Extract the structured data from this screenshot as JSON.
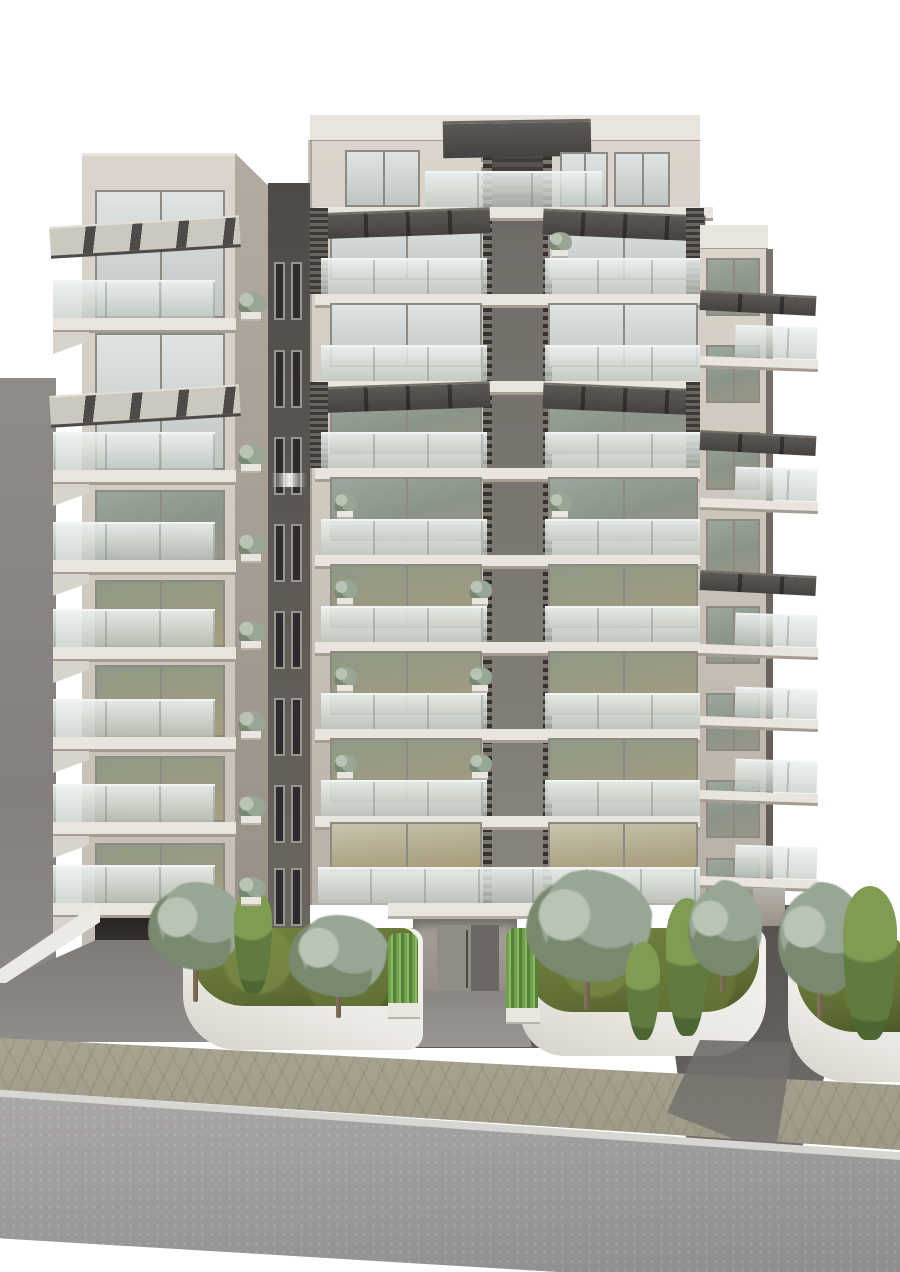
{
  "scene": {
    "type": "architectural-rendering",
    "subject": "modern multi-storey apartment building, street elevation",
    "time_of_day": "overcast daylight",
    "street_elements": [
      "paved sidewalk",
      "asphalt road",
      "white curb",
      "garage ramps",
      "curved white planters"
    ]
  },
  "palette": {
    "sky": "#ffffff",
    "wall-n1": "#8f8b88",
    "wall-n2": "#847f7c",
    "wall-n3": "#8d8986",
    "fac1": "#dbd5cd",
    "fac2": "#cfc8be",
    "fac3": "#c2bab0",
    "fac4": "#b6afa5",
    "side1": "#b3aba0",
    "side2": "#968e83",
    "slab": "#e9e5de",
    "slab-sh": "#a59d92",
    "slab-sh2": "#d8d3cb",
    "conn1": "#4e4a47",
    "conn2": "#5d5853",
    "conn3": "#6e6862",
    "core1": "#6e6964",
    "core2": "#7d7772",
    "core3": "#8a847e",
    "louv1": "#343130",
    "louv2": "#7b756e",
    "frame": "#8d8983",
    "frame2": "#9a958f",
    "awn-l": "#ccc7bf",
    "awn-dk": "#4d4a47",
    "awn-d1": "#5d5853",
    "awn-d2": "#45423f",
    "grass": "#5d6c33",
    "grass-l": "#76853f",
    "grass-d": "#4c5a2a",
    "olive": "#98a795",
    "olive-l": "#b9c4b4",
    "olive-d": "#79896f",
    "cyp": "#5f7b40",
    "cyp-l": "#7f9c52",
    "cyp-d": "#4c6634",
    "bam": "#6fa04a",
    "bam-l": "#8fba62",
    "bam-d": "#55803a",
    "trunk": "#86755c",
    "planter-w": "#eceae5",
    "walk1": "#a9a492",
    "walk2": "#9e9986",
    "curb": "#d8d6d2",
    "road1": "#aaa7a8",
    "road2": "#8f8d8f"
  },
  "building": {
    "left_tower": {
      "visible_floors": 7,
      "floors": [
        {
          "window_y": 190,
          "window_h": 128,
          "tint": "sky",
          "awning_y": 221,
          "rail_y": 280,
          "slab_y": 318
        },
        {
          "window_y": 333,
          "window_h": 137,
          "tint": "sky",
          "awning_y": 390,
          "rail_y": 432,
          "slab_y": 470
        },
        {
          "window_y": 490,
          "window_h": 70,
          "tint": "mid",
          "rail_y": 522,
          "slab_y": 560
        },
        {
          "window_y": 580,
          "window_h": 67,
          "tint": "low",
          "rail_y": 609,
          "slab_y": 647
        },
        {
          "window_y": 665,
          "window_h": 72,
          "tint": "low",
          "rail_y": 699,
          "slab_y": 737
        },
        {
          "window_y": 756,
          "window_h": 66,
          "tint": "low",
          "rail_y": 784,
          "slab_y": 822
        },
        {
          "window_y": 843,
          "window_h": 60,
          "tint": "low",
          "rail_y": 865,
          "slab_y": 903
        }
      ]
    },
    "center_tower": {
      "visible_floors": 9,
      "penthouse": {
        "rail_y": 171,
        "rail_x": 425,
        "rail_w": 177,
        "win_left": {
          "x": 345,
          "y": 150,
          "w": 75,
          "h": 57
        },
        "win_right_a": {
          "x": 560,
          "y": 152,
          "w": 48,
          "h": 55
        },
        "win_right_b": {
          "x": 614,
          "y": 152,
          "w": 56,
          "h": 55
        },
        "slab_y": 207
      },
      "floors": [
        {
          "window_y": 216,
          "window_h": 64,
          "tint": "sky",
          "awning": true,
          "rail_y": 258,
          "slab_y": 294
        },
        {
          "window_y": 303,
          "window_h": 64,
          "tint": "sky",
          "rail_y": 345,
          "slab_y": 381
        },
        {
          "window_y": 390,
          "window_h": 64,
          "tint": "mid",
          "awning": true,
          "rail_y": 432,
          "slab_y": 468
        },
        {
          "window_y": 477,
          "window_h": 64,
          "tint": "mid",
          "rail_y": 519,
          "slab_y": 555
        },
        {
          "window_y": 564,
          "window_h": 64,
          "tint": "low",
          "rail_y": 606,
          "slab_y": 642
        },
        {
          "window_y": 651,
          "window_h": 64,
          "tint": "low",
          "rail_y": 693,
          "slab_y": 729
        },
        {
          "window_y": 738,
          "window_h": 64,
          "tint": "low",
          "rail_y": 780,
          "slab_y": 816
        },
        {
          "window_y": 822,
          "window_h": 50,
          "tint": "lit",
          "rail_y": 867,
          "rail_full": true,
          "slab_y": null
        }
      ]
    },
    "right_wing": {
      "windows_y": [
        258,
        345,
        432,
        519,
        606,
        693,
        780,
        858
      ],
      "awnings_y": [
        293,
        433,
        573
      ],
      "balconies": [
        {
          "rail_y": 326,
          "slab_y": 358
        },
        {
          "rail_y": 468,
          "slab_y": 500
        },
        {
          "rail_y": 614,
          "slab_y": 646
        },
        {
          "rail_y": 688,
          "slab_y": 718
        },
        {
          "rail_y": 760,
          "slab_y": 792
        },
        {
          "rail_y": 846,
          "slab_y": 878
        }
      ]
    },
    "connector": {
      "window_rows_y": [
        262,
        350,
        437,
        524,
        611,
        698,
        785,
        868
      ],
      "lit_row_index": 2
    },
    "balcony_bushes": {
      "left_tower_y": [
        292,
        444,
        534,
        621,
        711,
        796,
        877
      ],
      "center_tower": [
        {
          "x": 333,
          "y": 493
        },
        {
          "x": 333,
          "y": 580
        },
        {
          "x": 333,
          "y": 667
        },
        {
          "x": 333,
          "y": 754
        },
        {
          "x": 548,
          "y": 232
        },
        {
          "x": 548,
          "y": 493
        },
        {
          "x": 468,
          "y": 580
        },
        {
          "x": 468,
          "y": 667
        },
        {
          "x": 468,
          "y": 754
        }
      ]
    }
  },
  "landscape": {
    "planters": [
      {
        "name": "left-planter",
        "x": 183,
        "y": 928,
        "w": 240,
        "h": 122,
        "radius": "14px 14px 16px 55px",
        "grass": {
          "x": 190,
          "y": 928,
          "w": 226,
          "h": 78
        }
      },
      {
        "name": "center-planter",
        "x": 520,
        "y": 928,
        "w": 246,
        "h": 128,
        "radius": "14px 14px 55px 45px",
        "grass": {
          "x": 527,
          "y": 928,
          "w": 232,
          "h": 84
        }
      },
      {
        "name": "far-right-planter",
        "x": 788,
        "y": 940,
        "w": 112,
        "h": 142,
        "radius": "14px 4px 0px 60px",
        "grass": {
          "x": 796,
          "y": 940,
          "w": 104,
          "h": 92
        }
      }
    ],
    "trees": [
      {
        "kind": "olive",
        "x": 148,
        "y": 882,
        "w": 98,
        "h": 88,
        "trunk": {
          "x": 193,
          "y": 960,
          "w": 5,
          "h": 42
        }
      },
      {
        "kind": "cypress",
        "x": 234,
        "y": 888,
        "w": 38,
        "h": 106
      },
      {
        "kind": "olive",
        "x": 288,
        "y": 915,
        "w": 102,
        "h": 82,
        "trunk": {
          "x": 336,
          "y": 986,
          "w": 5,
          "h": 32
        }
      },
      {
        "kind": "olive",
        "x": 526,
        "y": 870,
        "w": 128,
        "h": 112,
        "trunk": {
          "x": 584,
          "y": 972,
          "w": 6,
          "h": 38
        }
      },
      {
        "kind": "cypress",
        "x": 626,
        "y": 942,
        "w": 34,
        "h": 98
      },
      {
        "kind": "cypress",
        "x": 666,
        "y": 898,
        "w": 42,
        "h": 138
      },
      {
        "kind": "olive",
        "x": 688,
        "y": 880,
        "w": 74,
        "h": 96,
        "trunk": {
          "x": 720,
          "y": 962,
          "w": 5,
          "h": 30
        }
      },
      {
        "kind": "olive",
        "x": 778,
        "y": 882,
        "w": 88,
        "h": 112,
        "trunk": {
          "x": 817,
          "y": 982,
          "w": 6,
          "h": 36
        }
      },
      {
        "kind": "cypress",
        "x": 843,
        "y": 886,
        "w": 54,
        "h": 154
      }
    ],
    "bamboo_planters": [
      {
        "x": 388,
        "y": 933,
        "w": 30,
        "h": 72,
        "box": {
          "x": 388,
          "y": 1003,
          "w": 32,
          "h": 16
        }
      },
      {
        "x": 506,
        "y": 928,
        "w": 32,
        "h": 82,
        "box": {
          "x": 506,
          "y": 1008,
          "w": 34,
          "h": 16
        }
      }
    ],
    "step_boxes": [
      {
        "x": 537,
        "y": 905,
        "w": 58,
        "h": 18
      },
      {
        "x": 545,
        "y": 923,
        "w": 50,
        "h": 22
      }
    ]
  }
}
